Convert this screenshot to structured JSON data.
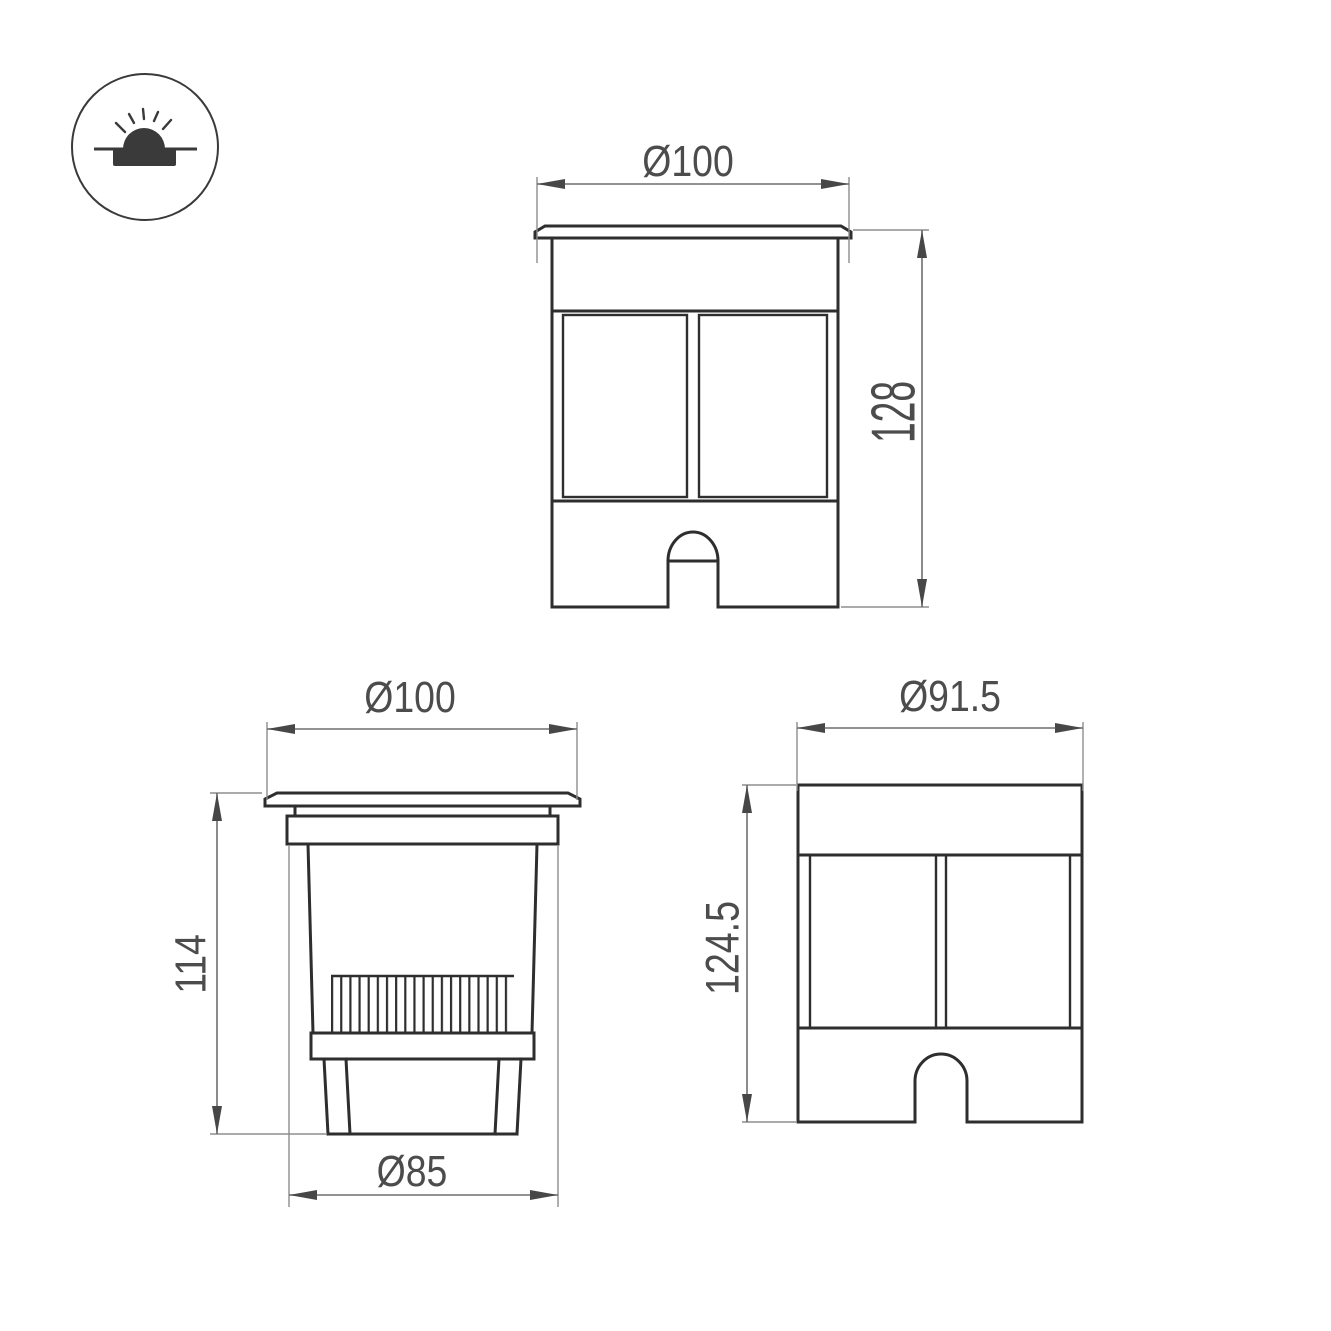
{
  "drawing": {
    "icon": {
      "meaning": "recessed-ground-luminaire-symbol"
    },
    "front_view": {
      "width_dim": "Ø100",
      "height_dim": "128"
    },
    "side_view": {
      "top_width_dim": "Ø100",
      "height_dim": "114",
      "bottom_width_dim": "Ø85"
    },
    "body_view": {
      "width_dim": "Ø91.5",
      "height_dim": "124.5"
    }
  }
}
